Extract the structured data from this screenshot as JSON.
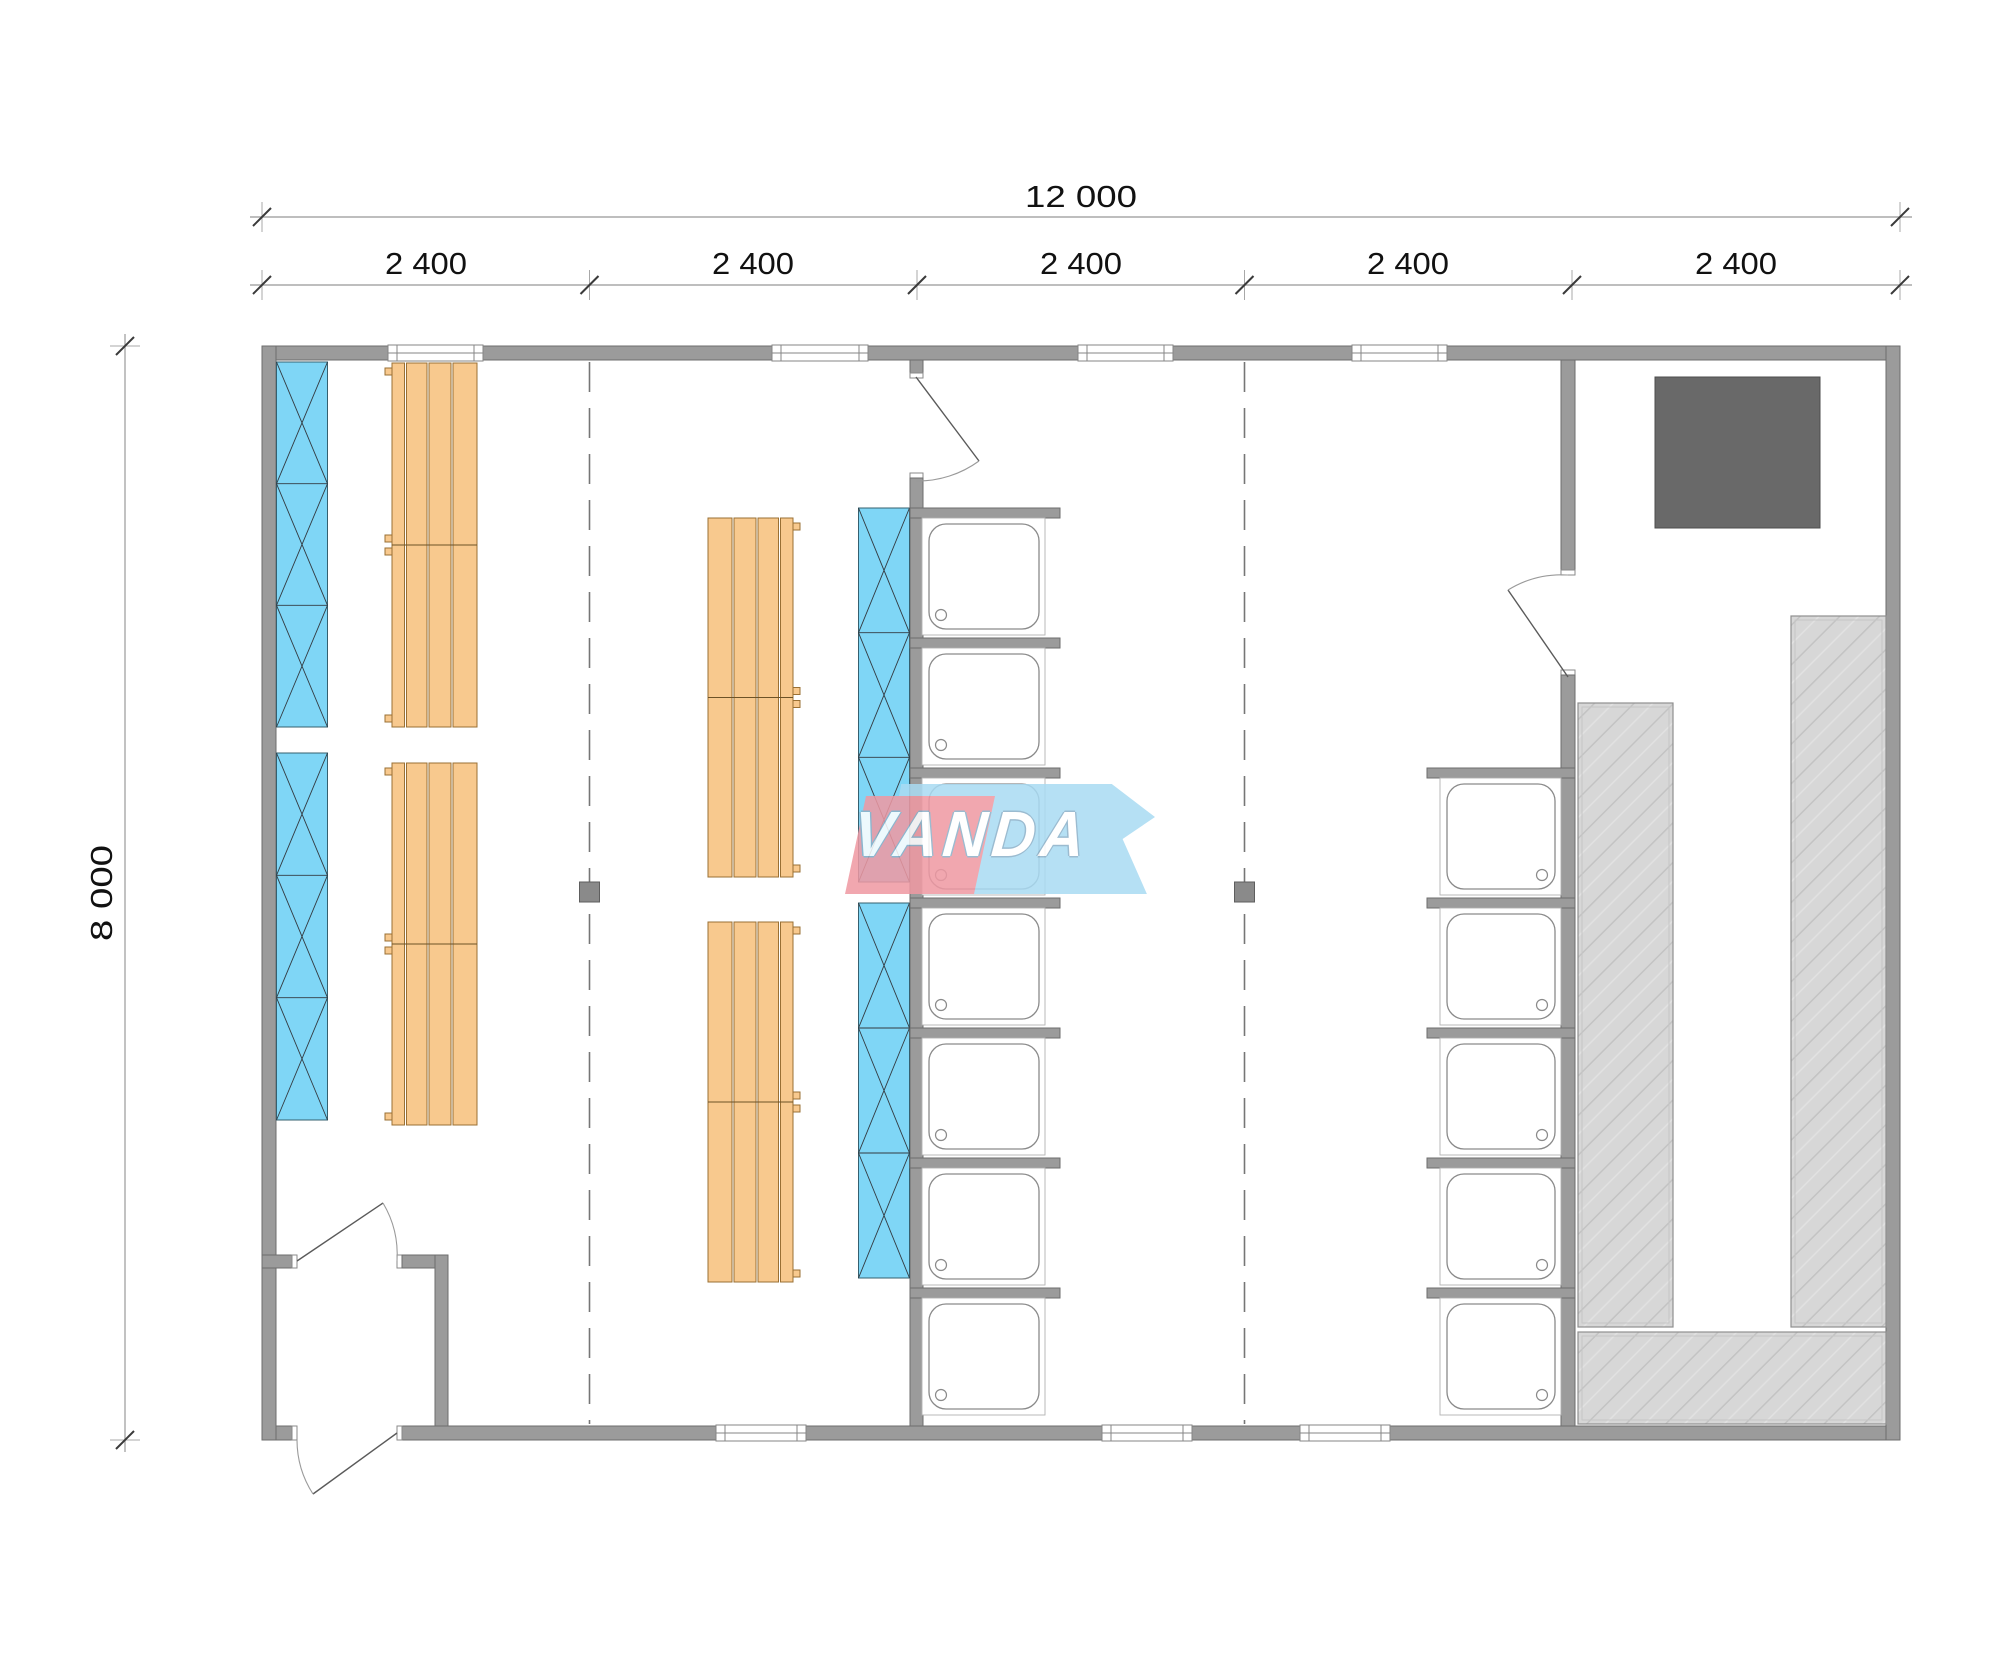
{
  "dimensions": {
    "overall_width": "12 000",
    "overall_height": "8 000",
    "segments": [
      "2 400",
      "2 400",
      "2 400",
      "2 400",
      "2 400"
    ]
  },
  "watermark": {
    "text": "VANDA"
  },
  "colors": {
    "wall_gray": "#9b9b9b",
    "glass_blue": "#7fd6f6",
    "bench_orange": "#f8c98e",
    "deck_gray": "#d7d7d7",
    "stove_gray": "#696969",
    "logo_blue": "#a9dbf3",
    "logo_red": "#ef99a3"
  },
  "plan": {
    "modules": 5,
    "shower_trays_left_column": 7,
    "shower_trays_right_column": 5,
    "top_windows": 4,
    "bottom_windows": 3,
    "doors": 4,
    "glass_panel_blocks": 4,
    "glass_cells_per_block": 3,
    "bench_groups": 4
  }
}
